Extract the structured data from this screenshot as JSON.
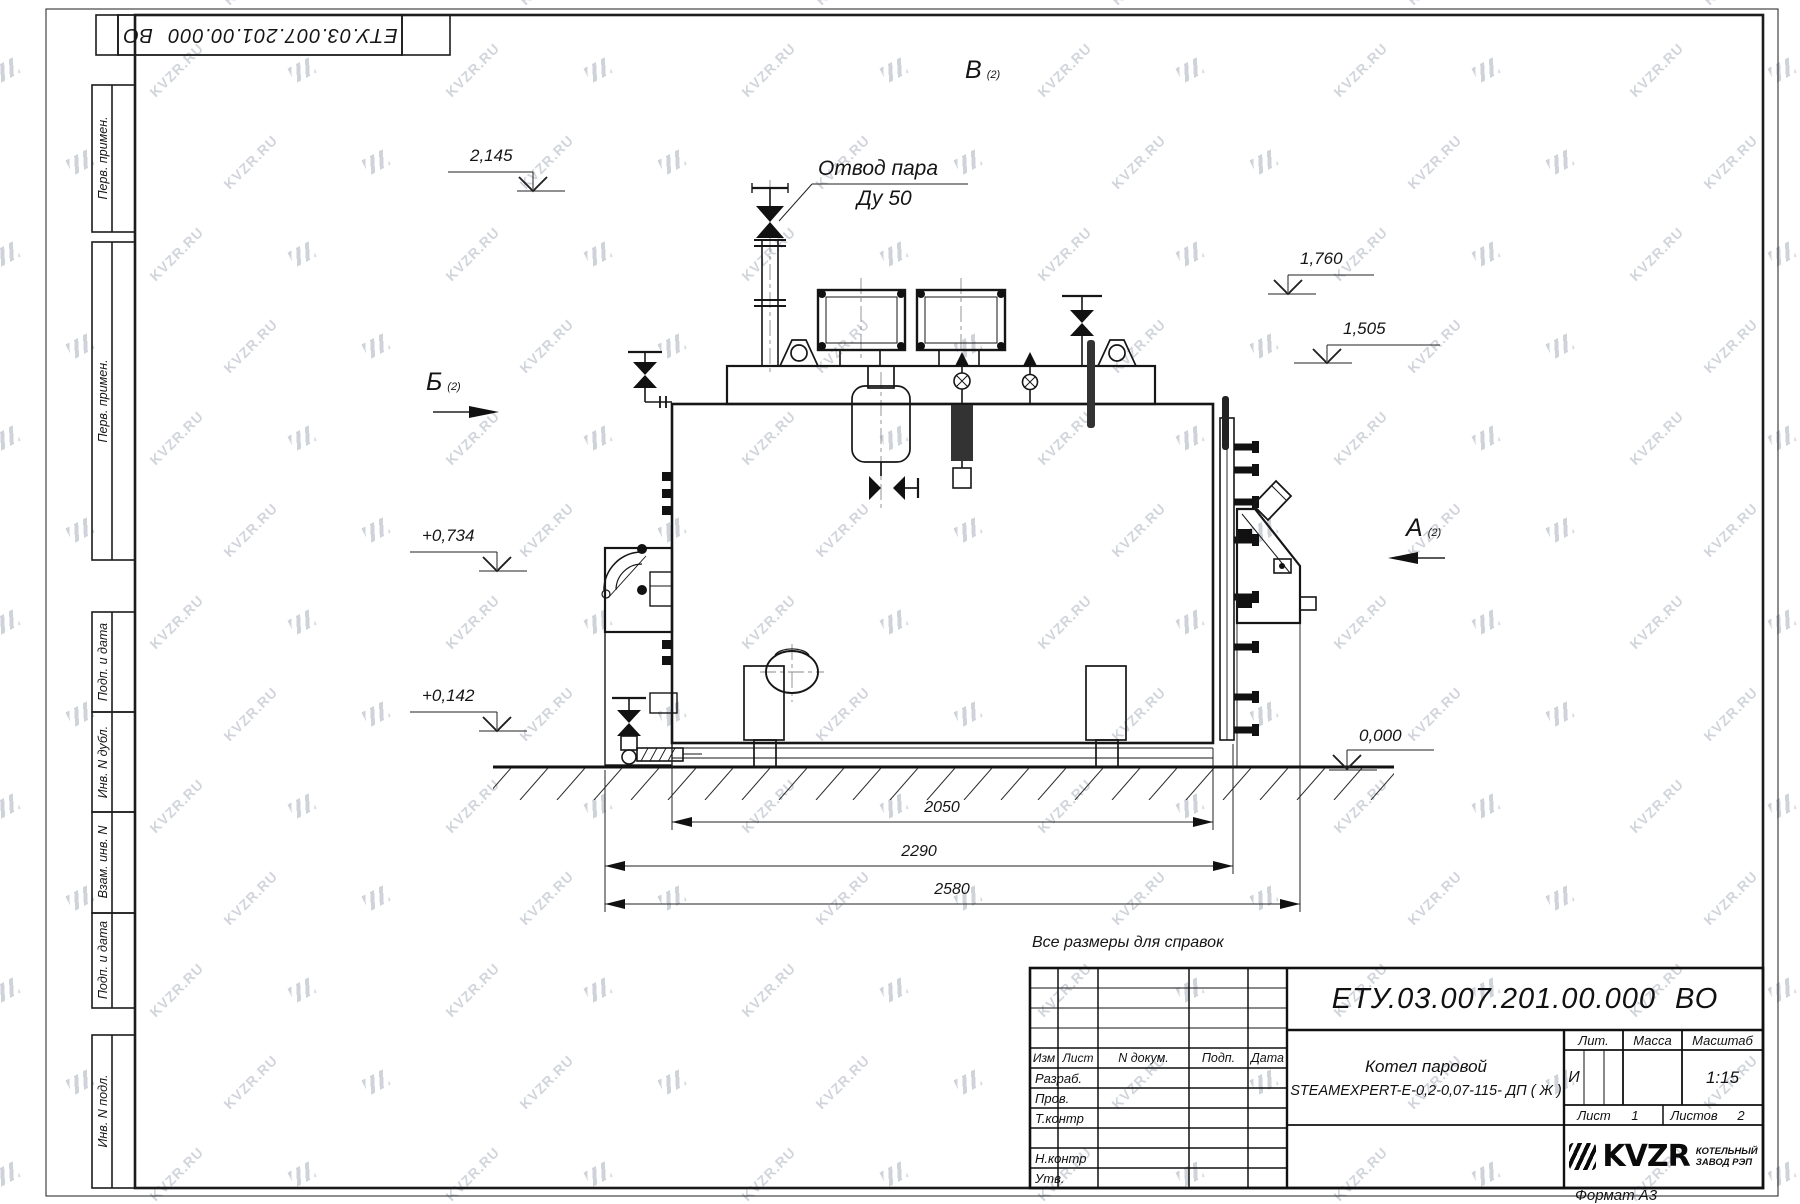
{
  "watermark": {
    "text": "KVZR.RU"
  },
  "margin_labels": {
    "b1": "Перв. примен.",
    "b2": "Перв. примен.",
    "b3": "Подп. и дата",
    "b4": "Инв. N дубл.",
    "b5": "Взам. инв. N",
    "b6": "Подп. и дата",
    "b7": "Инв. N подл."
  },
  "annotations": {
    "reference_note": "Все размеры для справок",
    "steam_outlet_line1": "Отвод пара",
    "steam_outlet_line2": "Ду 50",
    "view_a": "А",
    "view_b": "Б",
    "view_v": "В",
    "view_suffix": "(2)",
    "levels": {
      "l2145": "2,145",
      "l1760": "1,760",
      "l1505": "1,505",
      "l0734": "+0,734",
      "l0142": "+0,142",
      "l0000": "0,000"
    },
    "dims": {
      "d2050": "2050",
      "d2290": "2290",
      "d2580": "2580"
    }
  },
  "title_block": {
    "designation": "ЕТУ.03.007.201.00.000 ВО",
    "product_line1": "Котел паровой",
    "product_line2": "STEAMEXPERT-E-0,2-0,07-115- ДП ( Ж )",
    "cols": {
      "izm": "Изм",
      "list": "Лист",
      "ndoc": "N докум.",
      "podp": "Подп.",
      "data": "Дата"
    },
    "rows": {
      "razrab": "Разраб.",
      "prov": "Пров.",
      "tkontr": "Т.контр",
      "nkontr": "Н.контр",
      "utv": "Утв."
    },
    "lit_label": "Лит.",
    "massa_label": "Масса",
    "masshtab_label": "Масштаб",
    "lit_value": "И",
    "scale_value": "1:15",
    "sheet_label": "Лист",
    "sheet_value": "1",
    "sheets_label": "Листов",
    "sheets_value": "2",
    "company_logo": "KVZR",
    "company_line1": "КОТЕЛЬНЫЙ",
    "company_line2": "ЗАВОД РЭП",
    "format_label": "Формат А3"
  }
}
